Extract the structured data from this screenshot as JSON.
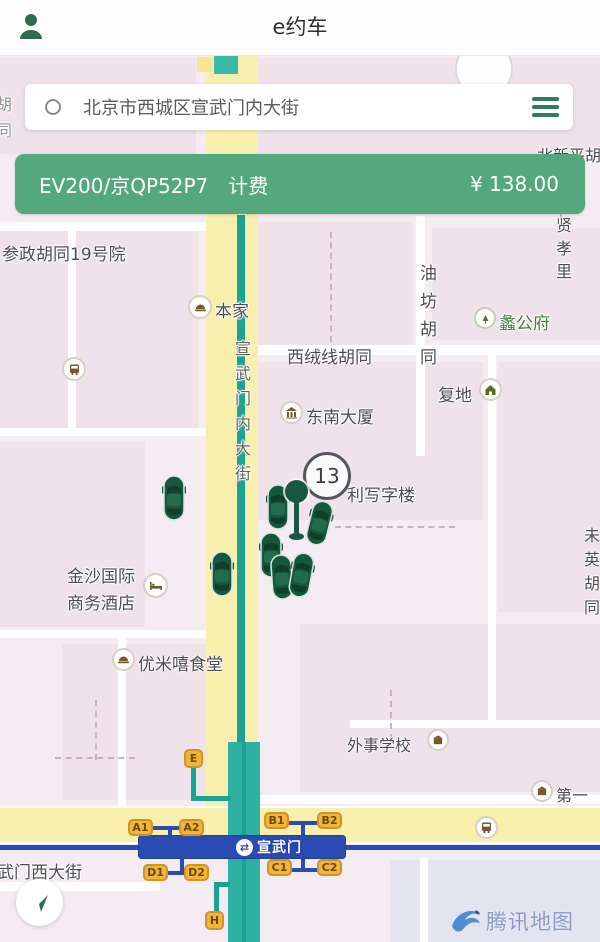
{
  "header": {
    "title": "e约车"
  },
  "search": {
    "address": "北京市西城区宣武门内大街"
  },
  "banner": {
    "vehicle": "EV200/京QP52P7",
    "status": "计费",
    "fare": "¥ 138.00"
  },
  "map": {
    "cluster_badge": "13",
    "labels": {
      "canzheng": "参政胡同19号院",
      "benjia": "本家",
      "ligongfu": "蠡公府",
      "youfang": "油坊胡同",
      "xianxiaoli": "贤孝里",
      "beixinping": "北新平胡",
      "xirongxian": "西绒线胡同",
      "fudi": "复地",
      "dongnan": "东南大厦",
      "lixiezilou": "利写字楼",
      "weiying": "未英胡同",
      "jinsha1": "金沙国际",
      "jinsha2": "商务酒店",
      "youmi": "优米嘻食堂",
      "waishi": "外事学校",
      "diyi": "第一",
      "xwm_west_street": "宣武门西大街",
      "road_vertical": "宣武门内大街",
      "edge_partial": "胡同"
    },
    "subway": {
      "station": "宣武门",
      "transfer_glyph": "⇄",
      "exits": {
        "a1": "A1",
        "a2": "A2",
        "b1": "B1",
        "b2": "B2",
        "c1": "C1",
        "c2": "C2",
        "d1": "D1",
        "d2": "D2",
        "e": "E",
        "h": "H"
      }
    },
    "attribution": {
      "brand": "腾讯地图"
    }
  },
  "colors": {
    "accent_green": "#55a77d",
    "road_yellow": "#f8efad",
    "map_teal": "#2db1a2",
    "subway_blue": "#2a4cb2",
    "exit_badge": "#f2b53b",
    "car_green": "#17573e"
  },
  "icons": {
    "person": "profile silhouette",
    "menu": "hamburger",
    "transfer": "⇄",
    "compass": "navigation arrow",
    "tencent_logo": "blue swirl"
  }
}
